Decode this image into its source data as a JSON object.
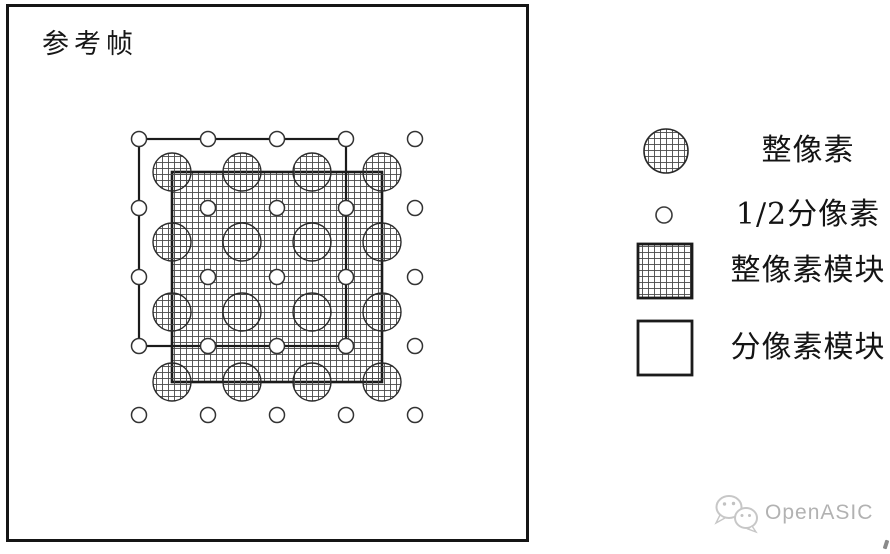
{
  "frame": {
    "label": "参考帧"
  },
  "diagram": {
    "full_pixel_grid": {
      "rows": 4,
      "cols": 4,
      "origin_x": 172,
      "origin_y": 172,
      "spacing": 70,
      "radius": 19
    },
    "half_pixel_grid": {
      "rows": 5,
      "cols": 5,
      "origin_x": 139,
      "origin_y": 139,
      "spacing": 69,
      "radius": 7.5
    },
    "full_pixel_block": {
      "x": 172,
      "y": 172,
      "size": 210
    },
    "sub_pixel_block": {
      "x": 139,
      "y": 139,
      "size": 207
    }
  },
  "legend": {
    "items": [
      {
        "marker": "full-pixel-circle",
        "label": "整像素"
      },
      {
        "marker": "half-pixel-circle",
        "label": "1/2分像素"
      },
      {
        "marker": "full-pixel-block",
        "label": "整像素模块"
      },
      {
        "marker": "sub-pixel-block",
        "label": "分像素模块"
      }
    ]
  },
  "watermark": {
    "brand": "OpenASIC",
    "icon": "wechat-icon"
  },
  "colors": {
    "line": "#1b1b1b",
    "hatch_line": "#484848",
    "circle_outline": "#2a2a2a",
    "watermark": "#b2b2b2",
    "background": "#ffffff"
  }
}
